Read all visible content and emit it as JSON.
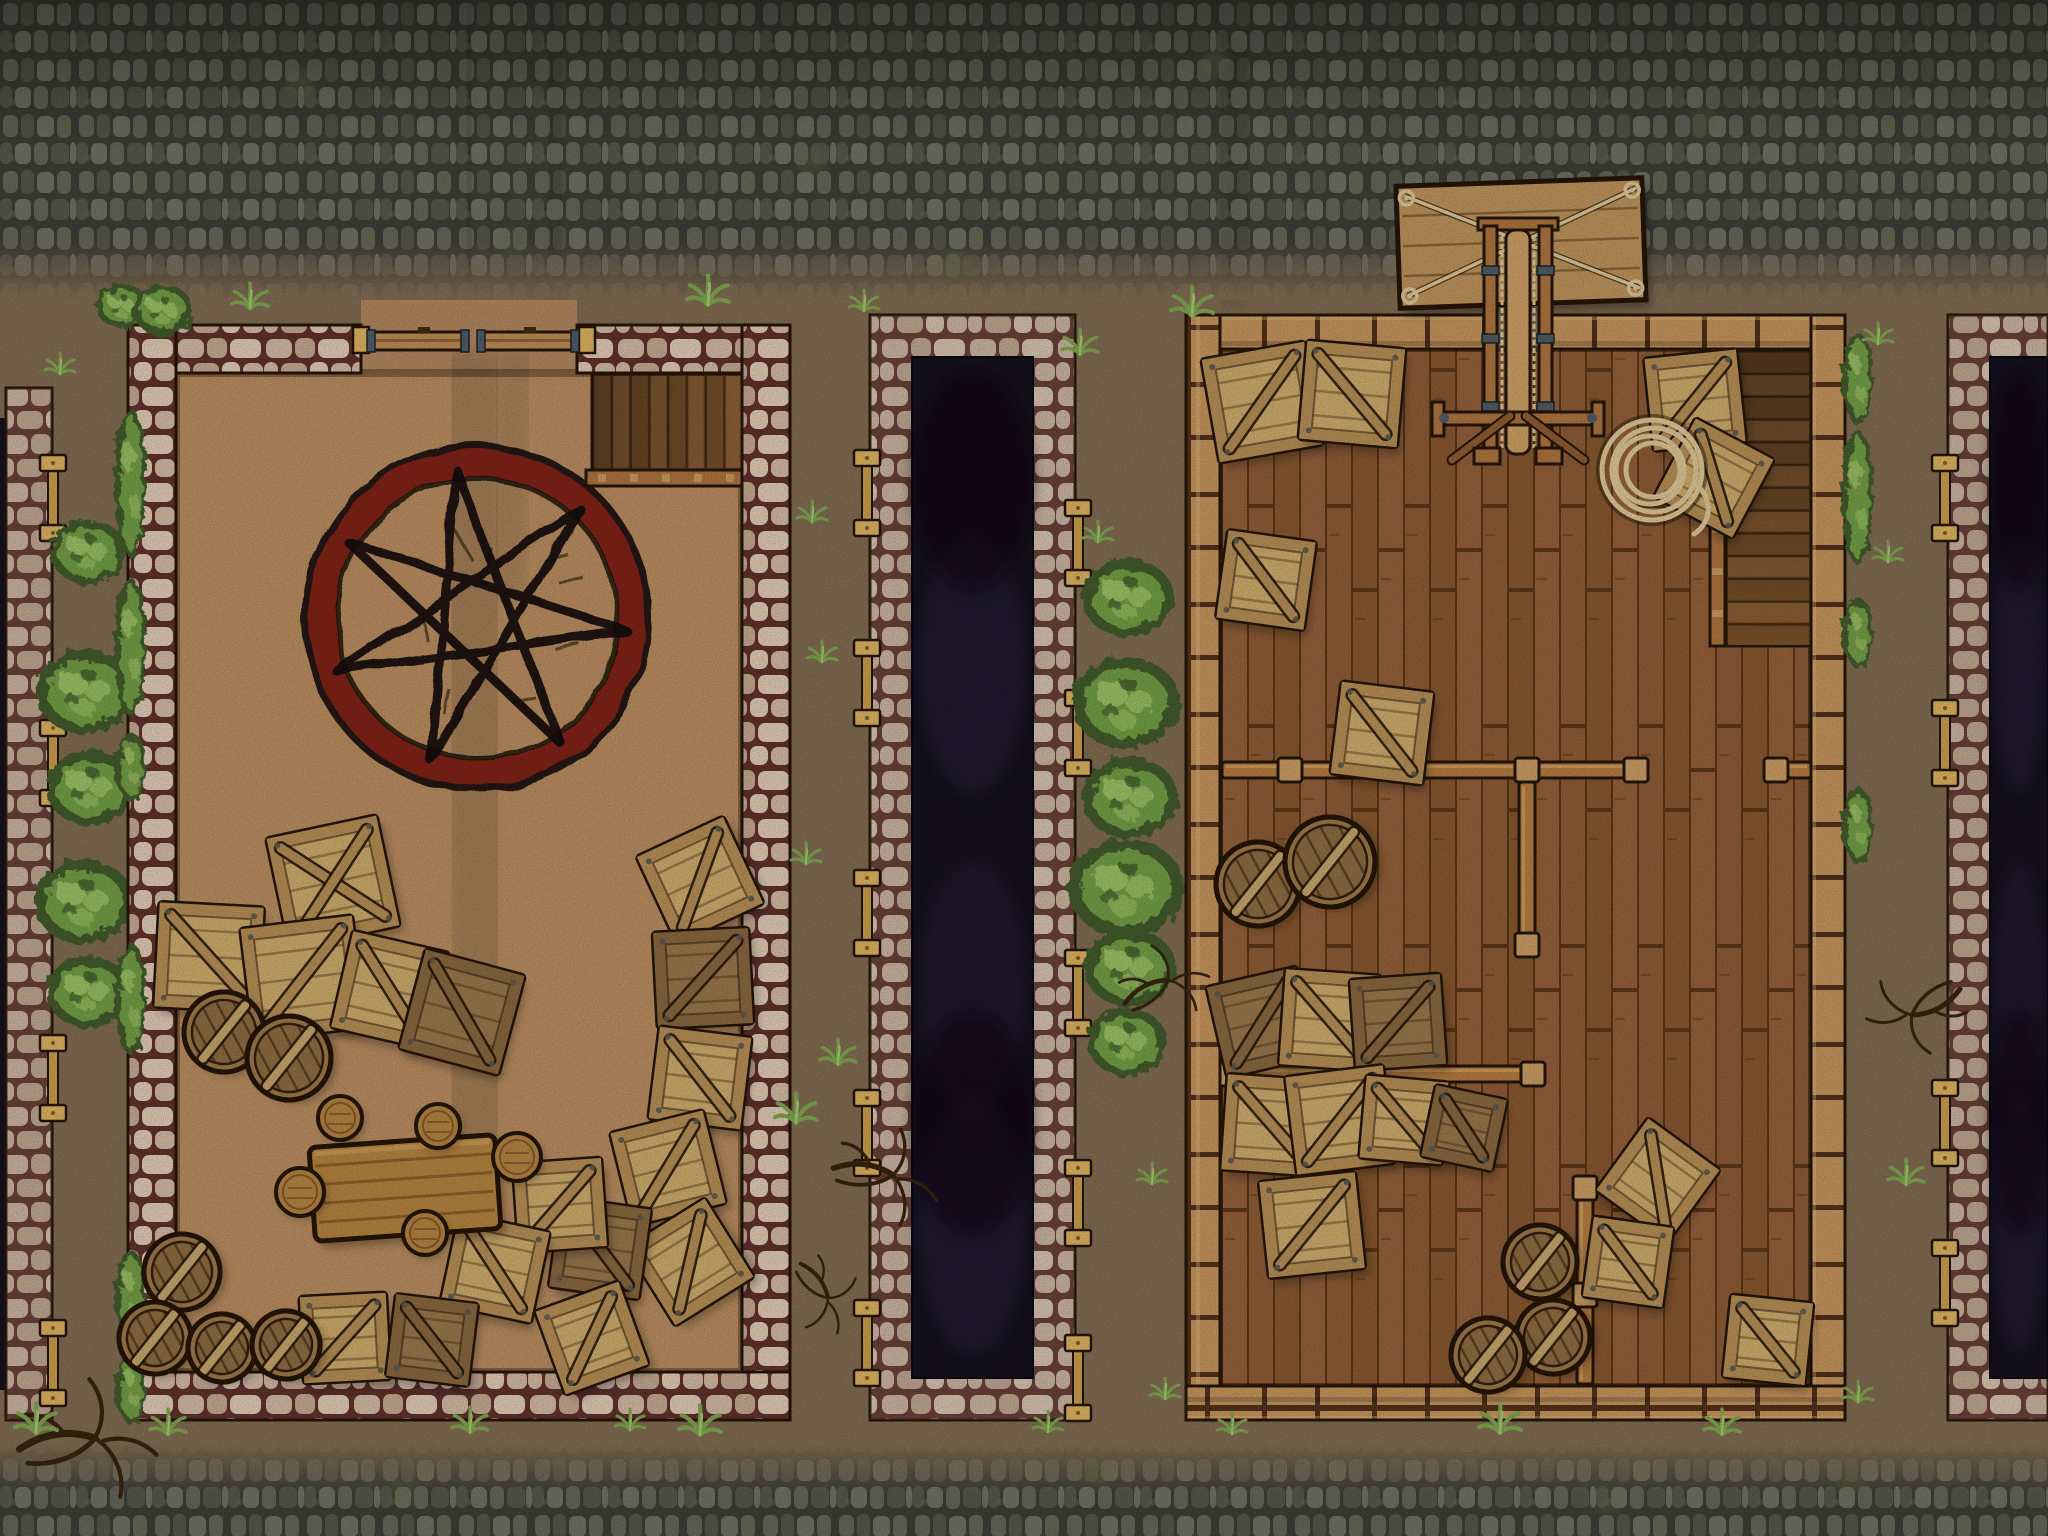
{
  "scene": {
    "width": 2048,
    "height": 1536
  },
  "palette": {
    "backdrop": "#7e6950",
    "court_dirt": "#b58a5e",
    "cobble_bg": "#3c3d35",
    "cobble_stone": "#62635a",
    "cobble_stone2": "#535449",
    "cobble_stone3": "#6d6e62",
    "moss": "#5d6b3c",
    "stone_mortar": "#5e2f2b",
    "stone_a": "#cdb5a1",
    "stone_b": "#bfa58f",
    "stone_c": "#dac6b1",
    "trench_dark": "#15111e",
    "trench_blotch": "#2b2344",
    "wood_wall": "#c0915a",
    "wood_joint": "#50301a",
    "floor": "#8a5a36",
    "floor_line": "#593517",
    "outline": "#241505",
    "crate_plank": "#c9a76a",
    "crate_frame": "#b28b54",
    "crate_plank_dark": "#96744a",
    "crate_frame_dark": "#86653e",
    "barrel": "#9a7648",
    "barrel_inner": "#8a6840",
    "strap": "#c2a169",
    "table_wood": "#b0813f",
    "ring_red": "#7d2416",
    "ink": "#140d08",
    "bush_dark": "#41582c",
    "bush_mid": "#6f9a44",
    "bush_light": "#a3c46c",
    "grass": "#7da24f",
    "brace_wood": "#c69a4a",
    "brace_cap": "#d8ae5e",
    "metal": "#4e5a64",
    "rope": "#d8c294",
    "branch": "#35230f",
    "stair_dark": "#6e4a28",
    "stair_a": "#8a5e35",
    "stair_b": "#775029",
    "rail": "#a9713d",
    "post": "#c59a62",
    "beam": "#b0793f"
  },
  "street": {
    "top_h": 300,
    "bottom_y": 1443,
    "tracks": [
      [
        470,
        0,
        468,
        300
      ],
      [
        558,
        0,
        552,
        300
      ],
      [
        1240,
        40,
        1228,
        310
      ]
    ],
    "moss_spots": [
      [
        300,
        82
      ],
      [
        812,
        162
      ],
      [
        1216,
        64
      ],
      [
        1704,
        122
      ],
      [
        512,
        242
      ],
      [
        956,
        262
      ],
      [
        404,
        1492
      ],
      [
        1096,
        1474
      ],
      [
        1608,
        1500
      ],
      [
        1852,
        1482
      ]
    ]
  },
  "left_rampart": {
    "x": 6,
    "y": 388,
    "w": 46,
    "h": 1032,
    "brace_ys": [
      455,
      720,
      1035,
      1320
    ]
  },
  "left_bushes": [
    {
      "x": 88,
      "y": 552,
      "r": 38
    },
    {
      "x": 86,
      "y": 692,
      "r": 50
    },
    {
      "x": 90,
      "y": 788,
      "r": 44
    },
    {
      "x": 84,
      "y": 902,
      "r": 50
    },
    {
      "x": 88,
      "y": 992,
      "r": 42
    }
  ],
  "mid_bushes": [
    {
      "x": 1128,
      "y": 598,
      "r": 46
    },
    {
      "x": 1126,
      "y": 703,
      "r": 54
    },
    {
      "x": 1130,
      "y": 798,
      "r": 48
    },
    {
      "x": 1126,
      "y": 888,
      "r": 58
    },
    {
      "x": 1130,
      "y": 968,
      "r": 46
    },
    {
      "x": 1127,
      "y": 1042,
      "r": 40
    }
  ],
  "left_building": {
    "x": 128,
    "y": 325,
    "w": 662,
    "h": 1095,
    "wall": 48,
    "gate": {
      "gap_x0": 361,
      "gap_x1": 577
    },
    "stairs": {
      "x": 592,
      "y": 374,
      "w": 150,
      "h": 96,
      "steps": 8
    },
    "circle": {
      "cx": 477,
      "cy": 618,
      "r": 170,
      "points": 7,
      "step": 3,
      "star_r": 150,
      "tilt": -8
    },
    "hedges": [
      {
        "y": 408,
        "h": 150
      },
      {
        "y": 578,
        "h": 138
      },
      {
        "y": 733,
        "h": 68
      },
      {
        "y": 943,
        "h": 112
      },
      {
        "y": 1250,
        "h": 92
      },
      {
        "y": 1354,
        "h": 70
      }
    ],
    "corner_bushes": [
      {
        "x": 122,
        "y": 306,
        "r": 26
      },
      {
        "x": 163,
        "y": 310,
        "r": 30
      }
    ],
    "crates": [
      {
        "x": 333,
        "y": 882,
        "s": 112,
        "rot": -12,
        "brace": "x"
      },
      {
        "x": 209,
        "y": 957,
        "s": 104,
        "rot": 3
      },
      {
        "x": 303,
        "y": 978,
        "s": 112,
        "rot": -7
      },
      {
        "x": 390,
        "y": 990,
        "s": 98,
        "rot": 13
      },
      {
        "x": 462,
        "y": 1012,
        "s": 102,
        "rot": 15,
        "tone": "dark"
      },
      {
        "x": 700,
        "y": 880,
        "s": 95,
        "rot": -25
      },
      {
        "x": 703,
        "y": 978,
        "s": 95,
        "rot": -3,
        "tone": "dark"
      },
      {
        "x": 700,
        "y": 1078,
        "s": 92,
        "rot": 7
      },
      {
        "x": 668,
        "y": 1168,
        "s": 95,
        "rot": -14
      },
      {
        "x": 690,
        "y": 1262,
        "s": 92,
        "rot": -32
      },
      {
        "x": 600,
        "y": 1248,
        "s": 90,
        "rot": 8,
        "tone": "dark"
      },
      {
        "x": 560,
        "y": 1205,
        "s": 88,
        "rot": -4
      },
      {
        "x": 495,
        "y": 1268,
        "s": 92,
        "rot": 12
      },
      {
        "x": 345,
        "y": 1338,
        "s": 86,
        "rot": -3
      },
      {
        "x": 432,
        "y": 1340,
        "s": 82,
        "rot": 7,
        "tone": "dark"
      },
      {
        "x": 592,
        "y": 1338,
        "s": 88,
        "rot": -20
      }
    ],
    "barrels": [
      {
        "x": 224,
        "y": 1032,
        "r": 40
      },
      {
        "x": 289,
        "y": 1058,
        "r": 42
      },
      {
        "x": 182,
        "y": 1272,
        "r": 38
      },
      {
        "x": 155,
        "y": 1338,
        "r": 36
      },
      {
        "x": 222,
        "y": 1348,
        "r": 34
      },
      {
        "x": 286,
        "y": 1345,
        "r": 34
      }
    ],
    "table": {
      "x": 405,
      "y": 1188,
      "w": 186,
      "h": 94,
      "rot": -4
    },
    "stools": [
      {
        "x": 340,
        "y": 1118,
        "r": 22
      },
      {
        "x": 438,
        "y": 1126,
        "r": 22
      },
      {
        "x": 517,
        "y": 1157,
        "r": 24
      },
      {
        "x": 300,
        "y": 1192,
        "r": 24
      },
      {
        "x": 425,
        "y": 1233,
        "r": 22
      }
    ]
  },
  "mid_trench": {
    "x": 870,
    "y": 315,
    "w": 205,
    "h": 1105,
    "wall": 42,
    "brace_left_ys": [
      450,
      640,
      870,
      1090,
      1300
    ],
    "brace_right_ys": [
      500,
      690,
      950,
      1160,
      1335
    ]
  },
  "right_trench": {
    "x": 1948,
    "y": 315,
    "w": 100,
    "h": 1105,
    "wall": 42,
    "open_right": true,
    "brace_left_ys": [
      455,
      700,
      1080,
      1240
    ],
    "brace_right_ys": []
  },
  "right_building": {
    "x": 1186,
    "y": 315,
    "w": 659,
    "h": 1105,
    "wall": 34,
    "gap_x0": 1484,
    "gap_x1": 1552,
    "stairs": {
      "x": 1726,
      "y": 350,
      "w": 85,
      "h": 296,
      "steps": 13
    },
    "partitions": [
      {
        "dir": "h",
        "x0": 1222,
        "x1": 1642,
        "y": 770,
        "posts": [
          1290,
          1412,
          1527,
          1636
        ]
      },
      {
        "dir": "h",
        "x0": 1771,
        "x1": 1811,
        "y": 770,
        "posts": [
          1776
        ]
      },
      {
        "dir": "v",
        "x": 1527,
        "y0": 782,
        "y1": 952,
        "posts": [
          945
        ]
      },
      {
        "dir": "h",
        "x0": 1217,
        "x1": 1540,
        "y": 1074,
        "posts": [
          1223,
          1345,
          1533
        ]
      },
      {
        "dir": "v",
        "x": 1585,
        "y0": 1182,
        "y1": 1384,
        "posts": [
          1188,
          1295
        ]
      }
    ],
    "crane": {
      "board": {
        "cx": 1521,
        "cy": 243,
        "w": 246,
        "h": 122,
        "rot": -2
      },
      "coil": {
        "x": 1652,
        "y": 470
      }
    },
    "crates": [
      {
        "x": 1262,
        "y": 402,
        "s": 104,
        "rot": -10
      },
      {
        "x": 1352,
        "y": 394,
        "s": 98,
        "rot": 5
      },
      {
        "x": 1695,
        "y": 400,
        "s": 92,
        "rot": -6
      },
      {
        "x": 1714,
        "y": 478,
        "s": 88,
        "rot": 28
      },
      {
        "x": 1266,
        "y": 580,
        "s": 88,
        "rot": 8
      },
      {
        "x": 1382,
        "y": 733,
        "s": 92,
        "rot": 7
      },
      {
        "x": 1262,
        "y": 1022,
        "s": 92,
        "rot": -13,
        "tone": "dark"
      },
      {
        "x": 1330,
        "y": 1020,
        "s": 95,
        "rot": 4
      },
      {
        "x": 1398,
        "y": 1022,
        "s": 90,
        "rot": -4,
        "tone": "dark"
      },
      {
        "x": 1272,
        "y": 1125,
        "s": 95,
        "rot": 4
      },
      {
        "x": 1340,
        "y": 1120,
        "s": 98,
        "rot": -7
      },
      {
        "x": 1404,
        "y": 1120,
        "s": 82,
        "rot": 5
      },
      {
        "x": 1464,
        "y": 1128,
        "s": 72,
        "rot": 12,
        "tone": "dark"
      },
      {
        "x": 1312,
        "y": 1225,
        "s": 96,
        "rot": -6
      },
      {
        "x": 1658,
        "y": 1180,
        "s": 88,
        "rot": 36
      },
      {
        "x": 1628,
        "y": 1262,
        "s": 80,
        "rot": 8
      },
      {
        "x": 1768,
        "y": 1340,
        "s": 82,
        "rot": 6
      }
    ],
    "barrels": [
      {
        "x": 1258,
        "y": 884,
        "r": 42
      },
      {
        "x": 1330,
        "y": 862,
        "r": 45
      },
      {
        "x": 1540,
        "y": 1262,
        "r": 37
      },
      {
        "x": 1553,
        "y": 1337,
        "r": 37
      },
      {
        "x": 1488,
        "y": 1355,
        "r": 37
      }
    ],
    "hedges": [
      {
        "y": 333,
        "h": 92
      },
      {
        "y": 430,
        "h": 135
      },
      {
        "y": 598,
        "h": 70
      },
      {
        "y": 788,
        "h": 76
      }
    ]
  },
  "branches": [
    {
      "x": 95,
      "y": 1438,
      "s": 1.4,
      "rot": 0
    },
    {
      "x": 893,
      "y": 1175,
      "s": 1.1,
      "rot": 15
    },
    {
      "x": 1168,
      "y": 980,
      "s": 0.9,
      "rot": -20
    },
    {
      "x": 1912,
      "y": 1015,
      "s": 1.0,
      "rot": 160
    },
    {
      "x": 828,
      "y": 1298,
      "s": 0.8,
      "rot": 60
    }
  ],
  "tufts": [
    [
      250,
      306
    ],
    [
      708,
      302
    ],
    [
      812,
      520
    ],
    [
      822,
      660
    ],
    [
      806,
      862
    ],
    [
      838,
      1062
    ],
    [
      796,
      1120
    ],
    [
      1098,
      540
    ],
    [
      1152,
      1182
    ],
    [
      864,
      309
    ],
    [
      1080,
      352
    ],
    [
      168,
      1432
    ],
    [
      470,
      1430
    ],
    [
      700,
      1432
    ],
    [
      1232,
      1432
    ],
    [
      1500,
      1430
    ],
    [
      1722,
      1432
    ],
    [
      1888,
      560
    ],
    [
      1878,
      342
    ],
    [
      1906,
      1182
    ],
    [
      60,
      372
    ],
    [
      36,
      1430
    ],
    [
      1165,
      1397
    ],
    [
      1858,
      1400
    ],
    [
      1192,
      313
    ],
    [
      630,
      1428
    ],
    [
      1048,
      1430
    ]
  ]
}
